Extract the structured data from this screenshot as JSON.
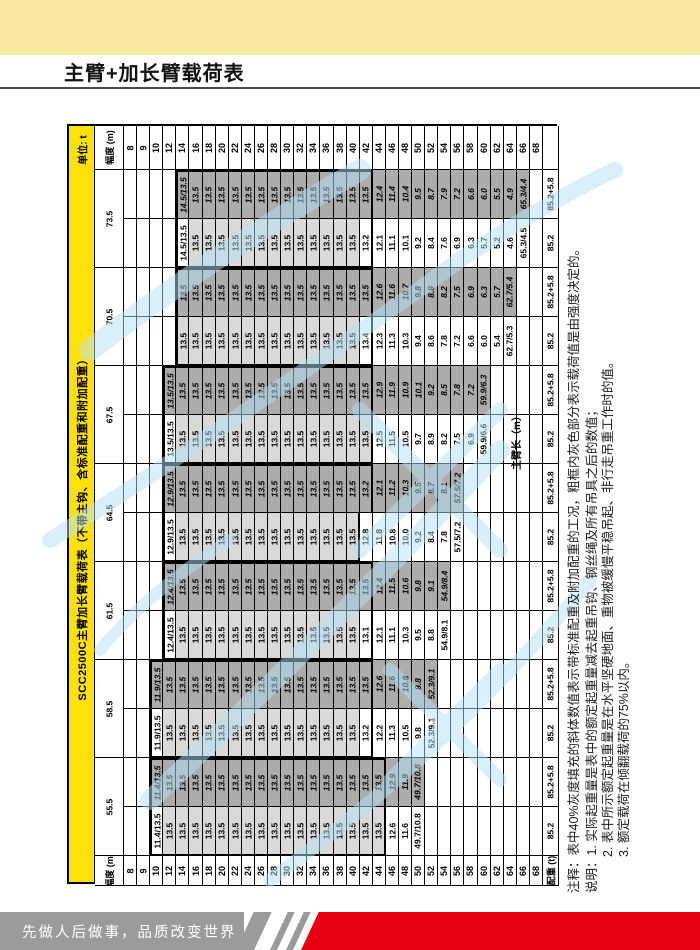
{
  "page": {
    "band_color": "#f9e8a0",
    "title": "主臂+加长臂载荷表",
    "footer_text": "先做人后做事，品质改变世界",
    "footer_gray": "#9b9b9b",
    "footer_red": "#e60012"
  },
  "table": {
    "title": "SCC2500C主臂加长臂载荷表（不带主钩、含标准配重和附加配重）",
    "unit_label": "单位: t",
    "radius_label": "幅度 (m)",
    "boom_label": "主臂长（m）",
    "cw_label": "配重 (t)",
    "strip_color": "#ffe10a",
    "gray_row_color": "#acacac",
    "plateau_color": "#d9d9d9",
    "radii": [
      "8",
      "9",
      "10",
      "12",
      "14",
      "16",
      "18",
      "20",
      "22",
      "24",
      "26",
      "28",
      "30",
      "32",
      "34",
      "36",
      "38",
      "40",
      "42",
      "44",
      "46",
      "48",
      "50",
      "52",
      "54",
      "56",
      "58",
      "60",
      "62",
      "64",
      "66",
      "68"
    ],
    "pairs": [
      {
        "boom": "73.5",
        "gray": {
          "cw": "85.2+5.8",
          "frame": [
            4,
            18
          ],
          "values": [
            "",
            "",
            "",
            "",
            "14.5/13.5",
            "13.5",
            "13.5",
            "13.5",
            "13.5",
            "13.5",
            "13.5",
            "13.5",
            "13.5",
            "13.5",
            "13.5",
            "13.5",
            "13.5",
            "13.5",
            "13.5",
            "12.4",
            "11.4",
            "10.4",
            "9.5",
            "8.7",
            "7.9",
            "7.2",
            "6.6",
            "6.0",
            "5.5",
            "4.9",
            "65.3/4.4",
            ""
          ]
        },
        "white": {
          "cw": "85.2",
          "frame": [
            4,
            18
          ],
          "values": [
            "",
            "",
            "",
            "",
            "14.5/13.5",
            "13.5",
            "13.5",
            "13.5",
            "13.5",
            "13.5",
            "13.5",
            "13.5",
            "13.5",
            "13.5",
            "13.5",
            "13.5",
            "13.5",
            "13.5",
            "13.2",
            "12.1",
            "11.1",
            "10.1",
            "9.2",
            "8.4",
            "7.6",
            "6.9",
            "6.3",
            "5.7",
            "5.2",
            "4.6",
            "65.3/4.5",
            ""
          ]
        }
      },
      {
        "boom": "70.5",
        "gray": {
          "cw": "85.2+5.8",
          "frame": [
            4,
            18
          ],
          "values": [
            "",
            "",
            "",
            "",
            "13.5",
            "13.5",
            "13.5",
            "13.5",
            "13.5",
            "13.5",
            "13.5",
            "13.5",
            "13.5",
            "13.5",
            "13.5",
            "13.5",
            "13.5",
            "13.5",
            "13.5",
            "12.6",
            "11.6",
            "10.7",
            "9.8",
            "8.9",
            "8.2",
            "7.5",
            "6.9",
            "6.3",
            "5.7",
            "62.7/5.4",
            "",
            ""
          ]
        },
        "white": {
          "cw": "85.2",
          "frame": [
            4,
            18
          ],
          "values": [
            "",
            "",
            "",
            "",
            "13.5",
            "13.5",
            "13.5",
            "13.5",
            "13.5",
            "13.5",
            "13.5",
            "13.5",
            "13.5",
            "13.5",
            "13.5",
            "13.5",
            "13.5",
            "13.5",
            "13.4",
            "12.3",
            "11.3",
            "10.3",
            "9.4",
            "8.6",
            "7.8",
            "7.2",
            "6.6",
            "6.0",
            "5.4",
            "62.7/5.3",
            "",
            ""
          ]
        }
      },
      {
        "boom": "67.5",
        "gray": {
          "cw": "85.2+5.8",
          "frame": [
            3,
            18
          ],
          "values": [
            "",
            "",
            "",
            "13.5/13.5",
            "13.5",
            "13.5",
            "13.5",
            "13.5",
            "13.5",
            "13.5",
            "13.5",
            "13.5",
            "13.5",
            "13.5",
            "13.5",
            "13.5",
            "13.5",
            "13.5",
            "13.5",
            "12.9",
            "11.9",
            "10.9",
            "10.1",
            "9.2",
            "8.5",
            "7.8",
            "7.2",
            "59.9/6.3",
            "",
            "",
            "",
            ""
          ]
        },
        "white": {
          "cw": "85.2",
          "frame": [
            3,
            18
          ],
          "values": [
            "",
            "",
            "",
            "13.5/13.5",
            "13.5",
            "13.5",
            "13.5",
            "13.5",
            "13.5",
            "13.5",
            "13.5",
            "13.5",
            "13.5",
            "13.5",
            "13.5",
            "13.5",
            "13.5",
            "13.5",
            "13.5",
            "12.5",
            "11.5",
            "10.5",
            "9.7",
            "8.9",
            "8.2",
            "7.5",
            "6.9",
            "59.9/6.6",
            "",
            "",
            "",
            ""
          ]
        }
      },
      {
        "boom": "64.5",
        "gray": {
          "cw": "85.2+5.8",
          "frame": [
            3,
            18
          ],
          "values": [
            "",
            "",
            "",
            "12.9/13.5",
            "13.5",
            "13.5",
            "13.5",
            "13.5",
            "13.5",
            "13.5",
            "13.5",
            "13.5",
            "13.5",
            "13.5",
            "13.5",
            "13.5",
            "13.5",
            "13.5",
            "13.2",
            "12.1",
            "11.2",
            "10.3",
            "9.5",
            "8.7",
            "8.1",
            "57.5/7.2",
            "",
            "",
            "",
            "",
            "",
            ""
          ]
        },
        "white": {
          "cw": "85.2",
          "frame": [
            3,
            17
          ],
          "values": [
            "",
            "",
            "",
            "12.9/13.5",
            "13.5",
            "13.5",
            "13.5",
            "13.5",
            "13.5",
            "13.5",
            "13.5",
            "13.5",
            "13.5",
            "13.5",
            "13.5",
            "13.5",
            "13.5",
            "13.5",
            "12.8",
            "11.8",
            "10.8",
            "10.0",
            "9.2",
            "8.4",
            "7.8",
            "57.5/7.2",
            "",
            "",
            "",
            "",
            "",
            ""
          ]
        }
      },
      {
        "boom": "61.5",
        "gray": {
          "cw": "85.2+5.8",
          "frame": [
            3,
            18
          ],
          "values": [
            "",
            "",
            "",
            "12.4/13.5",
            "13.5",
            "13.5",
            "13.5",
            "13.5",
            "13.5",
            "13.5",
            "13.5",
            "13.5",
            "13.5",
            "13.5",
            "13.5",
            "13.5",
            "13.5",
            "13.5",
            "13.5",
            "12.4",
            "11.5",
            "10.6",
            "9.8",
            "9.1",
            "54.9/8.4",
            "",
            "",
            "",
            "",
            "",
            "",
            ""
          ]
        },
        "white": {
          "cw": "85.2",
          "frame": [
            3,
            18
          ],
          "values": [
            "",
            "",
            "",
            "12.4/13.5",
            "13.5",
            "13.5",
            "13.5",
            "13.5",
            "13.5",
            "13.5",
            "13.5",
            "13.5",
            "13.5",
            "13.5",
            "13.5",
            "13.5",
            "13.5",
            "13.5",
            "13.1",
            "12.1",
            "11.1",
            "10.3",
            "9.5",
            "8.8",
            "54.9/8.1",
            "",
            "",
            "",
            "",
            "",
            "",
            ""
          ]
        }
      },
      {
        "boom": "58.5",
        "gray": {
          "cw": "85.2+5.8",
          "frame": [
            2,
            18
          ],
          "values": [
            "",
            "",
            "11.9/13.5",
            "13.5",
            "13.5",
            "13.5",
            "13.5",
            "13.5",
            "13.5",
            "13.5",
            "13.5",
            "13.5",
            "13.5",
            "13.5",
            "13.5",
            "13.5",
            "13.5",
            "13.5",
            "13.5",
            "12.6",
            "11.6",
            "10.8",
            "9.8",
            "52.3/9.1",
            "",
            "",
            "",
            "",
            "",
            "",
            "",
            ""
          ]
        },
        "white": {
          "cw": "85.2",
          "frame": [
            2,
            18
          ],
          "values": [
            "",
            "",
            "11.9/13.5",
            "13.5",
            "13.5",
            "13.5",
            "13.5",
            "13.5",
            "13.5",
            "13.5",
            "13.5",
            "13.5",
            "13.5",
            "13.5",
            "13.5",
            "13.5",
            "13.5",
            "13.5",
            "13.2",
            "12.2",
            "11.3",
            "10.5",
            "9.8",
            "52.3/9.1",
            "",
            "",
            "",
            "",
            "",
            "",
            "",
            ""
          ]
        }
      },
      {
        "boom": "55.5",
        "gray": {
          "cw": "85.2+5.8",
          "frame": [
            2,
            19
          ],
          "values": [
            "",
            "",
            "11.4/13.5",
            "13.5",
            "13.5",
            "13.5",
            "13.5",
            "13.5",
            "13.5",
            "13.5",
            "13.5",
            "13.5",
            "13.5",
            "13.5",
            "13.5",
            "13.5",
            "13.5",
            "13.5",
            "13.5",
            "13.5",
            "12.9",
            "11.9",
            "49.7/10.8",
            "",
            "",
            "",
            "",
            "",
            "",
            "",
            "",
            ""
          ]
        },
        "white": {
          "cw": "85.2",
          "frame": [
            2,
            19
          ],
          "values": [
            "",
            "",
            "11.4/13.5",
            "13.5",
            "13.5",
            "13.5",
            "13.5",
            "13.5",
            "13.5",
            "13.5",
            "13.5",
            "13.5",
            "13.5",
            "13.5",
            "13.5",
            "13.5",
            "13.5",
            "13.5",
            "13.5",
            "13.5",
            "12.6",
            "11.6",
            "49.7/10.8",
            "",
            "",
            "",
            "",
            "",
            "",
            "",
            "",
            ""
          ]
        }
      }
    ]
  },
  "notes": {
    "line1": "注释：表中40%灰度填充的斜体数值表示带标准配重及附加配重的工况，粗框内灰色部分表示载荷值是由强度决定的。",
    "line2": "说明：1. 实际起重量是表中的额定起重量减去起重吊钩、钢丝绳及所有吊具之后的数值；",
    "line3": "2. 表中所示额定起重量是在水平坚硬地面、重物被缓慢平稳吊起、非行走吊重工作时的值。",
    "line4": "3. 额定载荷在倾翻载荷的75%以内。"
  }
}
